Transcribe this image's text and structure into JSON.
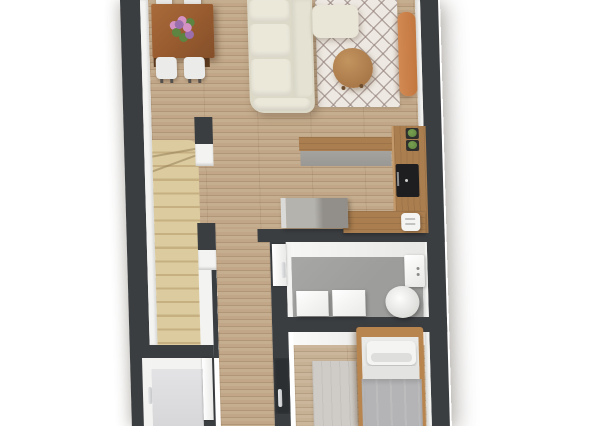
{
  "scene": {
    "type": "3d-floor-plan-render",
    "view": "top-down-orthographic",
    "background": "#ffffff",
    "text_visible": "none"
  },
  "rooms": [
    {
      "name": "living-dining-room",
      "floor": "wood-plank",
      "furniture": [
        "dining-table",
        "flower-bouquet",
        "dining-chairs-4",
        "sectional-sofa",
        "chaise",
        "diamond-pattern-rug",
        "round-coffee-table",
        "orange-bench"
      ]
    },
    {
      "name": "kitchen",
      "floor": "wood-plank",
      "furniture": [
        "upper-counter",
        "right-wall-counter",
        "cooktop",
        "kitchen-island",
        "lower-counter",
        "toaster",
        "potted-plants"
      ]
    },
    {
      "name": "staircase",
      "floor": "beige-stairs",
      "furniture": []
    },
    {
      "name": "hallway",
      "floor": "wood-plank",
      "furniture": []
    },
    {
      "name": "bathroom",
      "floor": "gray-screed",
      "furniture": [
        "washer",
        "dryer",
        "toilet",
        "cistern"
      ],
      "door": "white"
    },
    {
      "name": "bedroom",
      "floor": "wood-plank",
      "furniture": [
        "single-bed",
        "pillow",
        "gray-blanket",
        "bedroom-rug"
      ],
      "door": "dark"
    },
    {
      "name": "storage-room",
      "floor": "light-gray",
      "door": "white",
      "furniture": []
    }
  ],
  "colors": {
    "wall": "#3b3e41",
    "wall-face": "#f3f3f1",
    "floor-wood": "#c1a787",
    "floor-wood-dark": "rgba(92,64,40,0.16)",
    "floor-bedroom": "#c7b194",
    "stairs": "#dccb9e",
    "stairs-line": "#c6b082",
    "bath-floor": "#9d9d9b",
    "storage-floor": "#d7d7d9",
    "rug-base": "#ede8e1",
    "rug-line": "rgba(148,130,126,0.65)",
    "rug-bed": "#cfccc7",
    "sofa-base": "#ddd9c8",
    "sofa-cushion": "#ebe8da",
    "chaise": "#e9e6d7",
    "table-wood": "#95592e",
    "table-leg": "#5f3c1f",
    "chair": "#ebebe9",
    "coffee-a": "#c2945e",
    "coffee-b": "#a87748",
    "bench-a": "#d28a52",
    "bench-b": "#c2773f",
    "counter-wood": "#aa7e4f",
    "counter-face": "#9a9894",
    "island-a": "#b5b3ae",
    "island-b": "#928f8a",
    "bed-wood": "#b9854f",
    "mattress": "#e9e9e7",
    "pillow": "#f4f4f2",
    "sheet": "#e3e3e1",
    "blanket": "#b4b4b6",
    "fixture": "#f4f4f2",
    "stove": "#1e1e20",
    "door-dark": "#2c2f31",
    "chrome": "#c4c6c8",
    "plant": "#5d8440",
    "flower-a": "#9b6fae",
    "flower-b": "#d492c4"
  }
}
